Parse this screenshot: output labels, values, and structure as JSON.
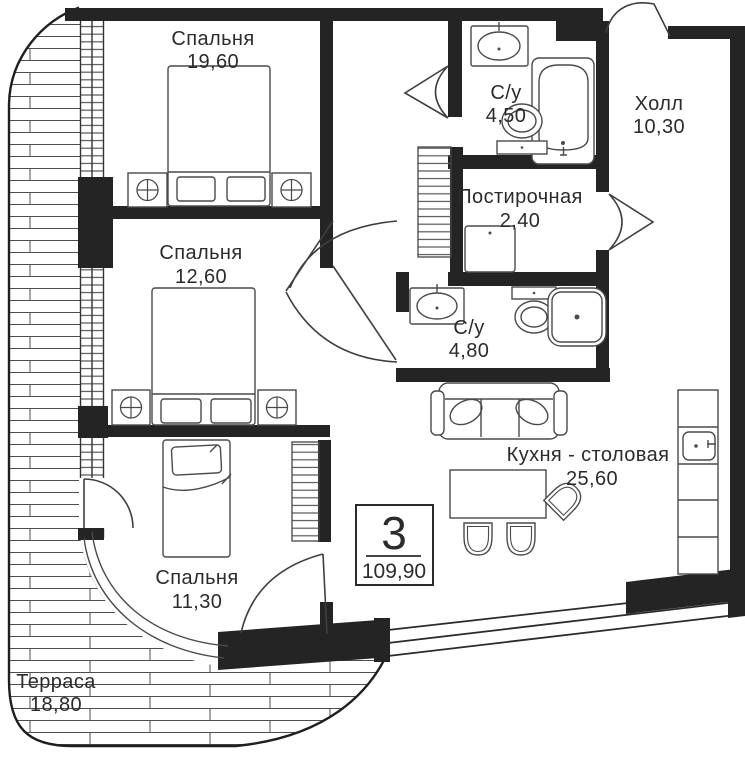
{
  "plan": {
    "info_box": {
      "rooms_count": "3",
      "total_area": "109,90"
    },
    "rooms": [
      {
        "id": "bedroom-1",
        "name": "Спальня",
        "area": "19,60"
      },
      {
        "id": "bathroom-1",
        "name": "С/у",
        "area": "4,50"
      },
      {
        "id": "hall",
        "name": "Холл",
        "area": "10,30"
      },
      {
        "id": "laundry",
        "name": "Постирочная",
        "area": "2,40"
      },
      {
        "id": "bedroom-2",
        "name": "Спальня",
        "area": "12,60"
      },
      {
        "id": "bathroom-2",
        "name": "С/у",
        "area": "4,80"
      },
      {
        "id": "kitchen-dining",
        "name": "Кухня - столовая",
        "area": "25,60"
      },
      {
        "id": "bedroom-3",
        "name": "Спальня",
        "area": "11,30"
      },
      {
        "id": "terrace",
        "name": "Терраса",
        "area": "18,80"
      }
    ],
    "colors": {
      "wall": "#242424",
      "line": "#3f3f3f",
      "text": "#2b2b2b",
      "background": "#ffffff"
    }
  }
}
